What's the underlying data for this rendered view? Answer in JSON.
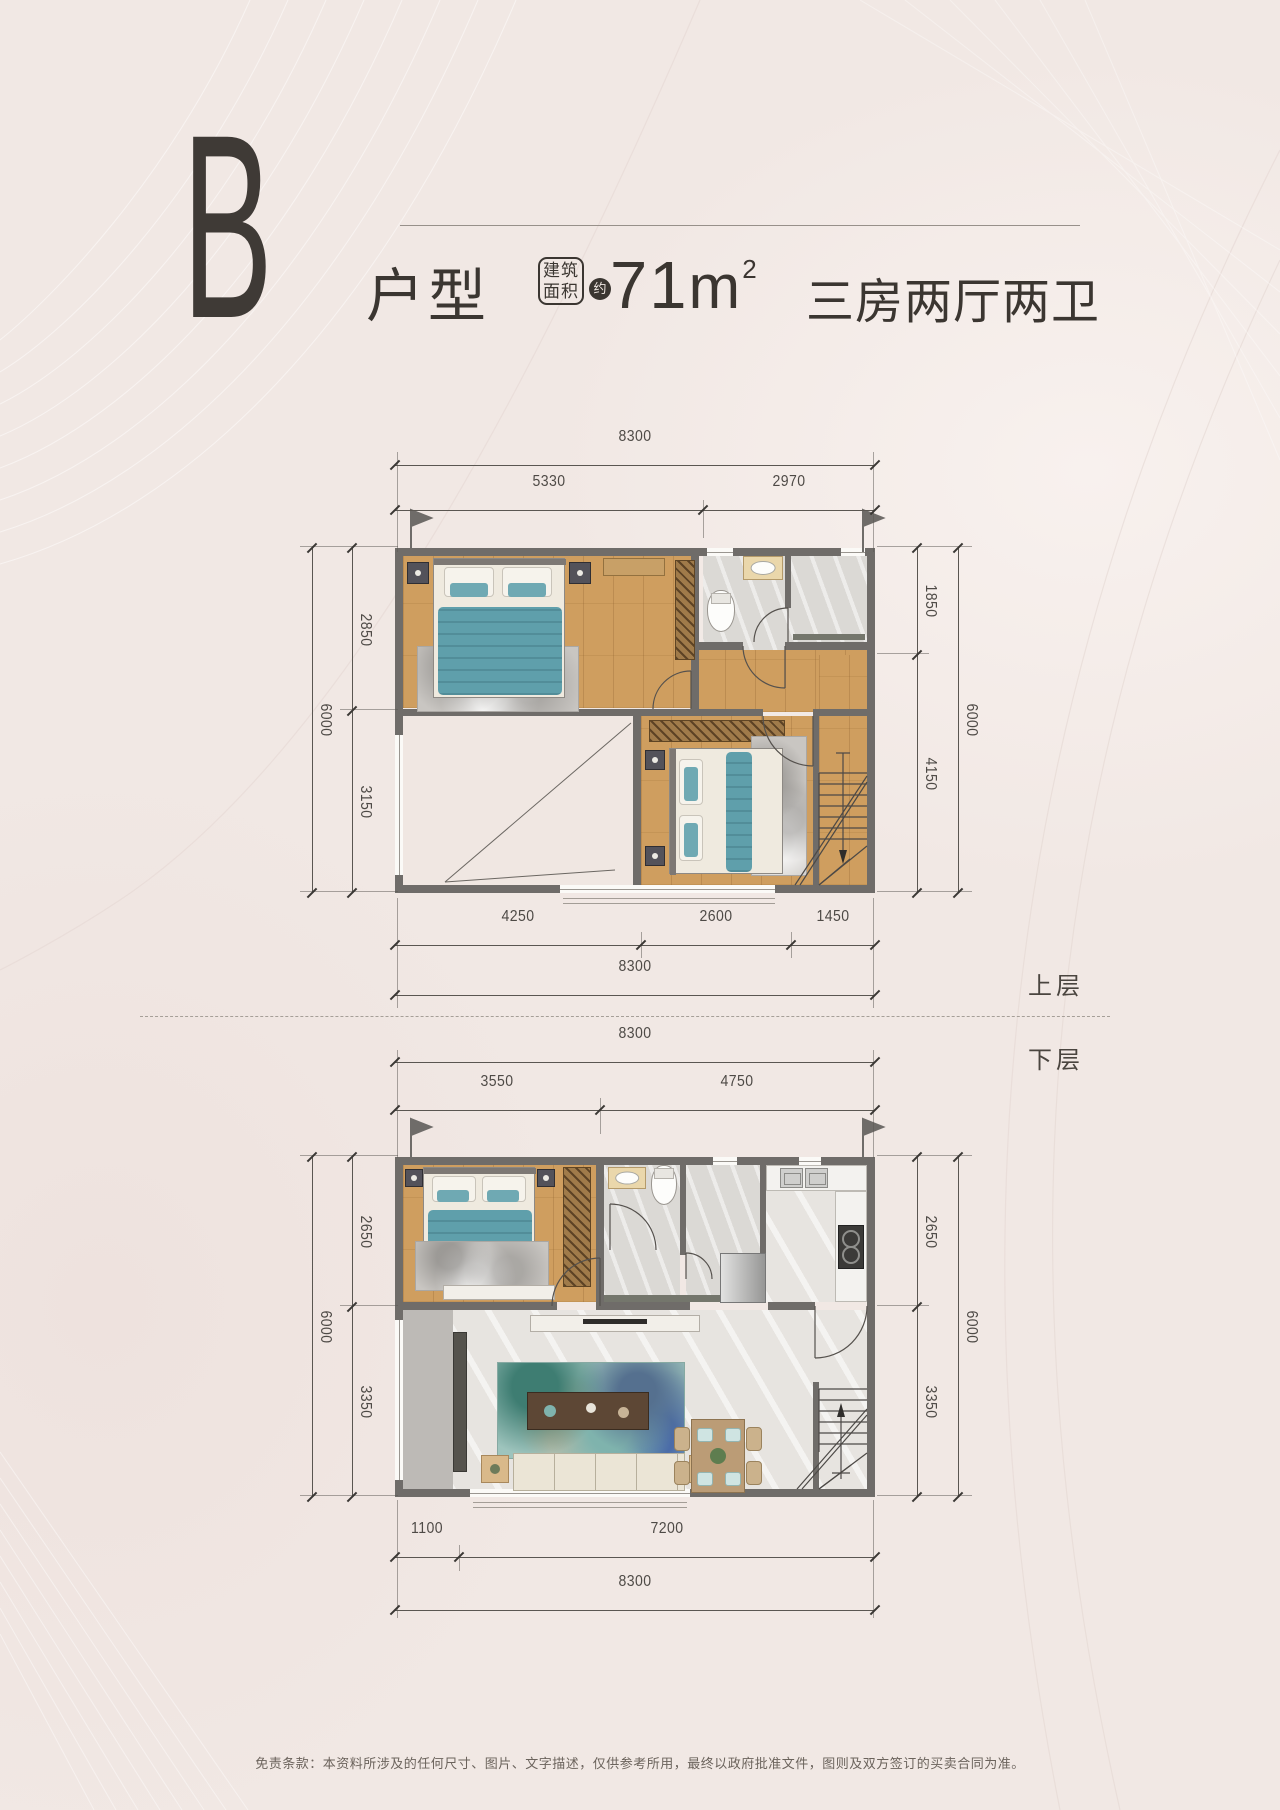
{
  "header": {
    "unit_letter": "B",
    "unit_type": "户型",
    "badge_top": "建筑",
    "badge_bottom": "面积",
    "approx": "约",
    "area_number": "71",
    "area_unit": "m",
    "area_exponent": "2",
    "rooms_summary": "三房两厅两卫"
  },
  "floor_labels": {
    "upper": "上层",
    "lower": "下层"
  },
  "upper_dims": {
    "top_total": "8300",
    "top_left": "5330",
    "top_right": "2970",
    "left_outer": "6000",
    "left_top": "2850",
    "left_bottom": "3150",
    "right_outer": "6000",
    "right_top": "1850",
    "right_bottom": "4150",
    "bottom_left": "4250",
    "bottom_mid": "2600",
    "bottom_right": "1450",
    "bottom_total": "8300"
  },
  "lower_dims": {
    "top_total": "8300",
    "top_left": "3550",
    "top_right": "4750",
    "left_outer": "6000",
    "left_top": "2650",
    "left_bottom": "3350",
    "right_outer": "6000",
    "right_top": "2650",
    "right_bottom": "3350",
    "bottom_left": "1100",
    "bottom_right": "7200",
    "bottom_total": "8300"
  },
  "footer": {
    "disclaimer": "免责条款：本资料所涉及的任何尺寸、图片、文字描述，仅供参考所用，最终以政府批准文件，图则及双方签订的买卖合同为准。"
  },
  "colors": {
    "accent_teal": "#5f9fab",
    "wall": "#6f6c69",
    "wood": "#cf9e5f",
    "title": "#3b3631"
  }
}
